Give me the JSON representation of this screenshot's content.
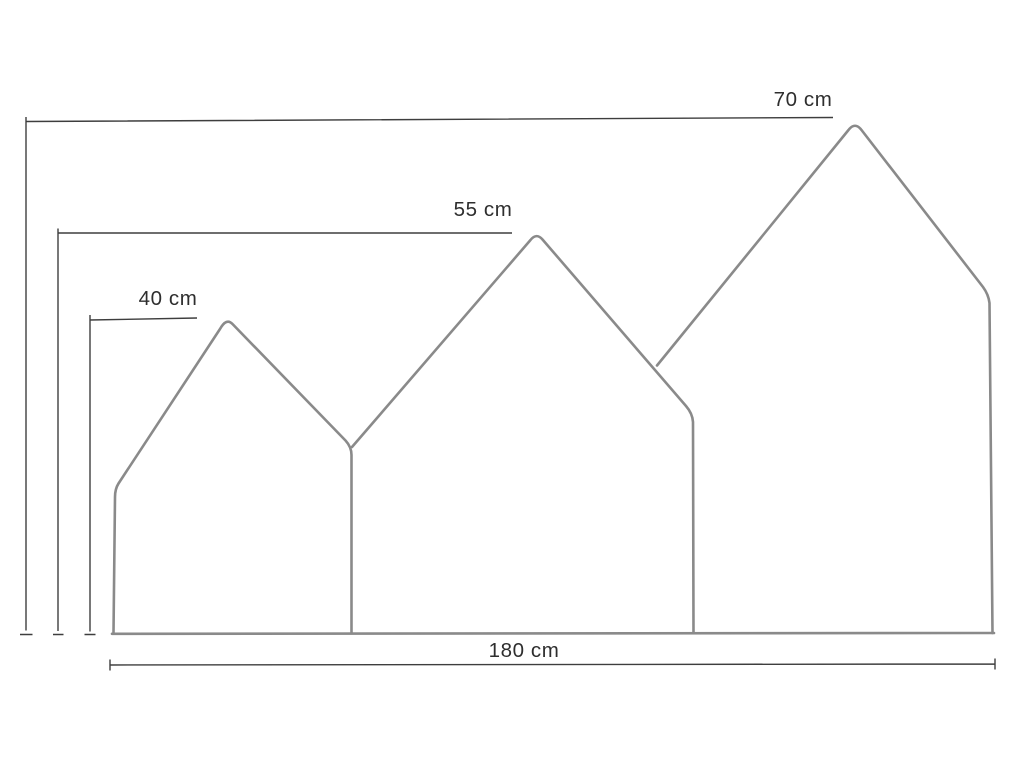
{
  "diagram": {
    "unit": "cm",
    "dimensions": {
      "height_large": {
        "label": "70 cm",
        "value": 70
      },
      "height_medium": {
        "label": "55 cm",
        "value": 55
      },
      "height_small": {
        "label": "40 cm",
        "value": 40
      },
      "total_width": {
        "label": "180 cm",
        "value": 180
      }
    },
    "colors": {
      "panel_outline": "#8a8a8a",
      "dimension_line": "#3e3e3e",
      "label_text": "#2e2e2e",
      "background": "#ffffff"
    }
  }
}
